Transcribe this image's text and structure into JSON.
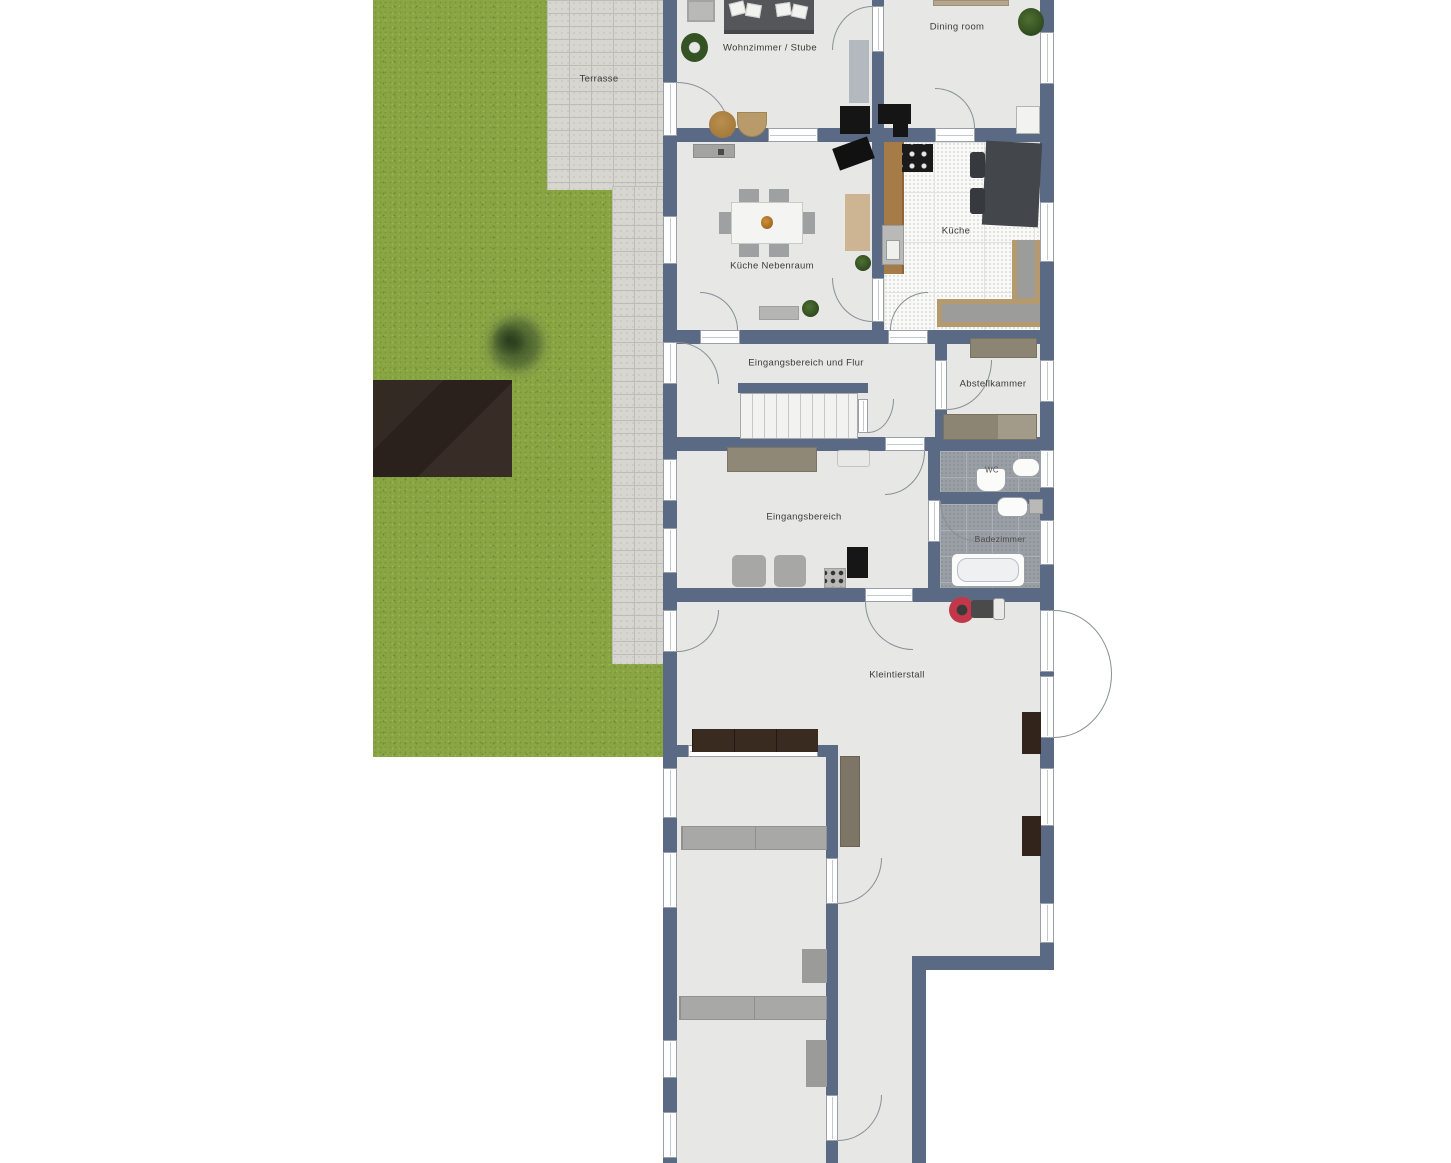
{
  "plan": {
    "kind": "residential floor plan with garden",
    "rooms": {
      "terrasse": "Terrasse",
      "wohnzimmer": "Wohnzimmer / Stube",
      "dining": "Dining room",
      "kueche_nebenraum": "Küche Nebenraum",
      "kueche": "Küche",
      "flur": "Eingangsbereich und Flur",
      "abstellkammer": "Abstellkammer",
      "eingangsbereich": "Eingangsbereich",
      "wc": "WC",
      "badezimmer": "Badezimmer",
      "kleintierstall": "Kleintierstall"
    },
    "colors": {
      "wall": "#5b6a84",
      "floor": "#e7e7e5",
      "grass": "#8aa544",
      "terrace_paving": "#d7d6d1",
      "garden_bed": "#2d2420",
      "kitchen_tile": "#f9f9f7",
      "bathroom_tile": "#9a9ea5",
      "wood_counter": "#a57c48",
      "dark_furniture": "#3a2b20",
      "mower_accent": "#c2374a"
    }
  }
}
